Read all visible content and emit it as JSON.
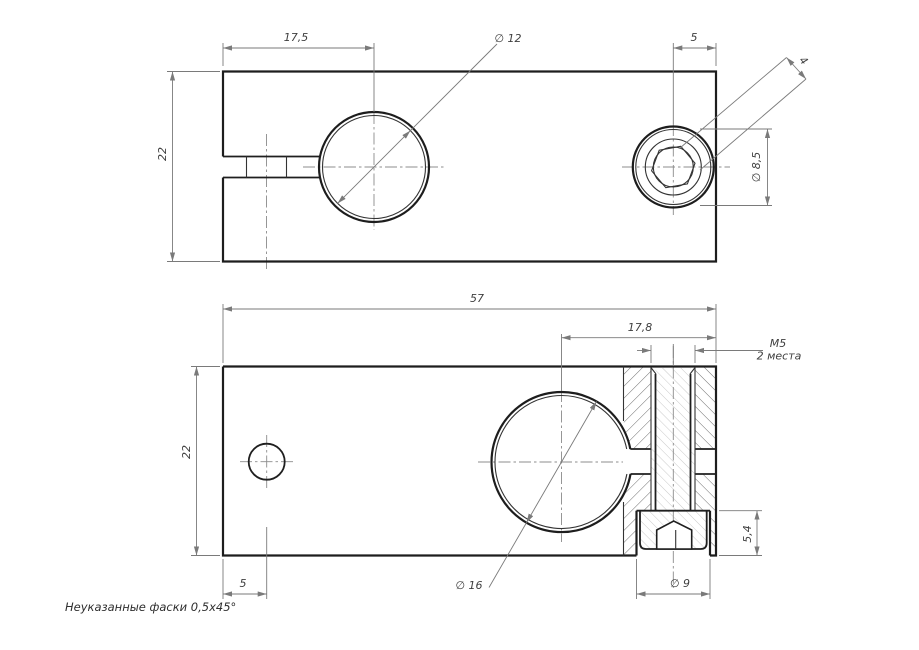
{
  "colors": {
    "outline": "#1d1d1d",
    "dimension": "#7a7a7a",
    "hatch": "#5f5f5f",
    "hatch_light": "#c4c4c4",
    "centerline": "#8c8c8c",
    "background": "#ffffff"
  },
  "front_view": {
    "dim_hole_offset": "17,5",
    "dim_bore": "∅ 12",
    "dim_screw_to_edge": "5",
    "dim_height": "22",
    "dim_head_dia": "∅ 8,5",
    "dim_hex_socket": "4"
  },
  "section_view": {
    "dim_length": "57",
    "dim_screw_position": "17,8",
    "thread_callout_line1": "M5",
    "thread_callout_line2": "2 места",
    "dim_height": "22",
    "dim_counterbore_depth": "5,4",
    "dim_side_hole_offset": "5",
    "dim_bore": "∅ 16",
    "dim_counterbore_dia": "∅ 9"
  },
  "note": "Неуказанные фаски 0,5x45°"
}
